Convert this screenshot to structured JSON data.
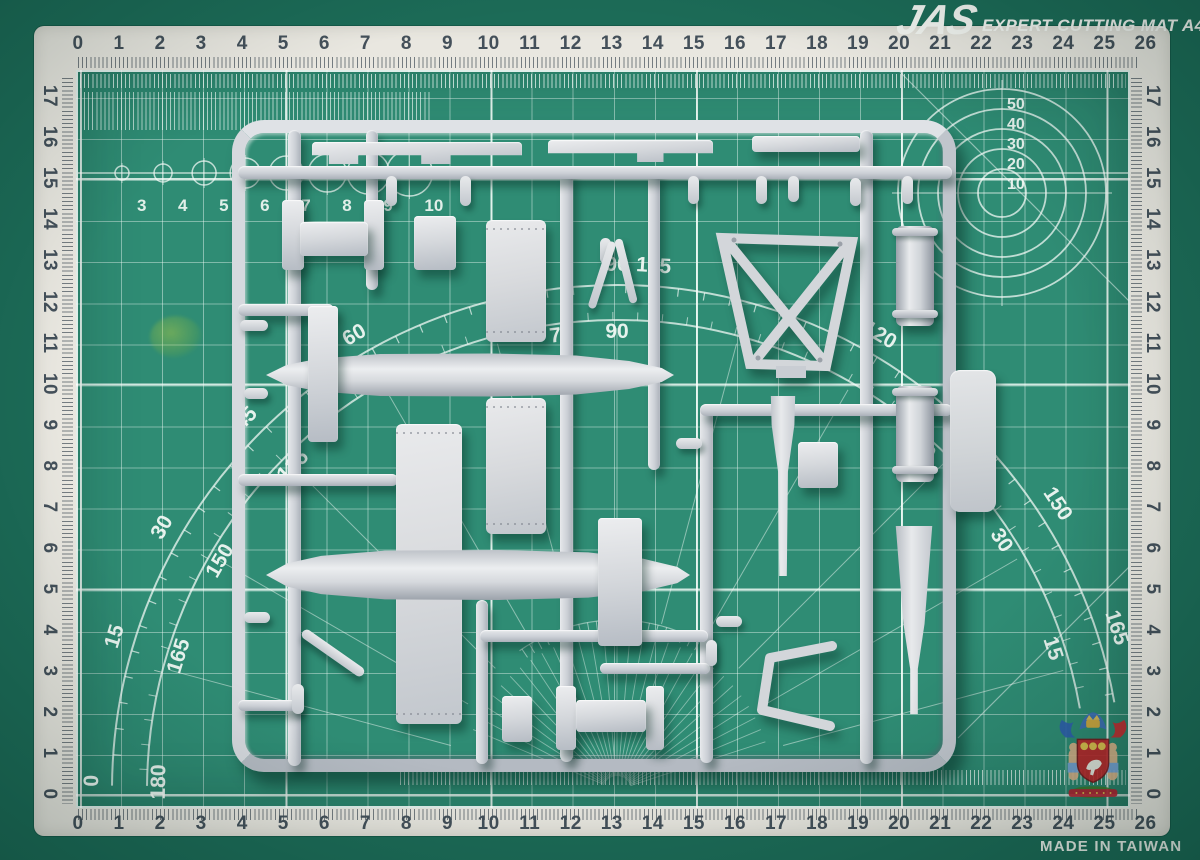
{
  "mat": {
    "brand": "JAS",
    "title": "EXPERT CUTTING MAT A4",
    "made_in": "MADE IN TAIWAN",
    "colors": {
      "mat_green": "#2f8c74",
      "mat_margin_green": "#1c6b57",
      "frame_white": "#e9e7e0",
      "ruler_number": "#44505a",
      "grid_line": "#f0faf6",
      "sprue_gray": "#ccd0d6"
    },
    "rulers": {
      "top": [
        "0",
        "1",
        "2",
        "3",
        "4",
        "5",
        "6",
        "7",
        "8",
        "9",
        "10",
        "11",
        "12",
        "13",
        "14",
        "15",
        "16",
        "17",
        "18",
        "19",
        "20",
        "21",
        "22",
        "23",
        "24",
        "25",
        "26"
      ],
      "bottom": [
        "0",
        "1",
        "2",
        "3",
        "4",
        "5",
        "6",
        "7",
        "8",
        "9",
        "10",
        "11",
        "12",
        "13",
        "14",
        "15",
        "16",
        "17",
        "18",
        "19",
        "20",
        "21",
        "22",
        "23",
        "24",
        "25",
        "26"
      ],
      "left": [
        "17",
        "16",
        "15",
        "14",
        "13",
        "12",
        "11",
        "10",
        "9",
        "8",
        "7",
        "6",
        "5",
        "4",
        "3",
        "2",
        "1",
        "0"
      ],
      "right": [
        "17",
        "16",
        "15",
        "14",
        "13",
        "12",
        "11",
        "10",
        "9",
        "8",
        "7",
        "6",
        "5",
        "4",
        "3",
        "2",
        "1",
        "0"
      ]
    },
    "circle_scale_labels": [
      "10",
      "20",
      "30",
      "40",
      "50"
    ],
    "diameter_row": [
      "3",
      "4",
      "5",
      "6",
      "7",
      "8",
      "9",
      "10"
    ],
    "protractor_labels": [
      {
        "angle": 179,
        "outer": "0",
        "inner": "180"
      },
      {
        "angle": 163,
        "outer": "15",
        "inner": "165"
      },
      {
        "angle": 150,
        "outer": "30",
        "inner": "150"
      },
      {
        "angle": 135,
        "outer": "45",
        "inner": "135"
      },
      {
        "angle": 120,
        "outer": "60",
        "inner": ""
      },
      {
        "angle": 97,
        "outer": "",
        "inner": "75"
      },
      {
        "angle": 90,
        "outer": "90",
        "inner": "90"
      },
      {
        "angle": 86,
        "outer": "105",
        "inner": ""
      },
      {
        "angle": 60,
        "outer": "120",
        "inner": ""
      },
      {
        "angle": 48,
        "outer": "",
        "inner": "60"
      },
      {
        "angle": 33,
        "outer": "150",
        "inner": "30"
      },
      {
        "angle": 18,
        "outer": "165",
        "inner": "15"
      }
    ]
  }
}
